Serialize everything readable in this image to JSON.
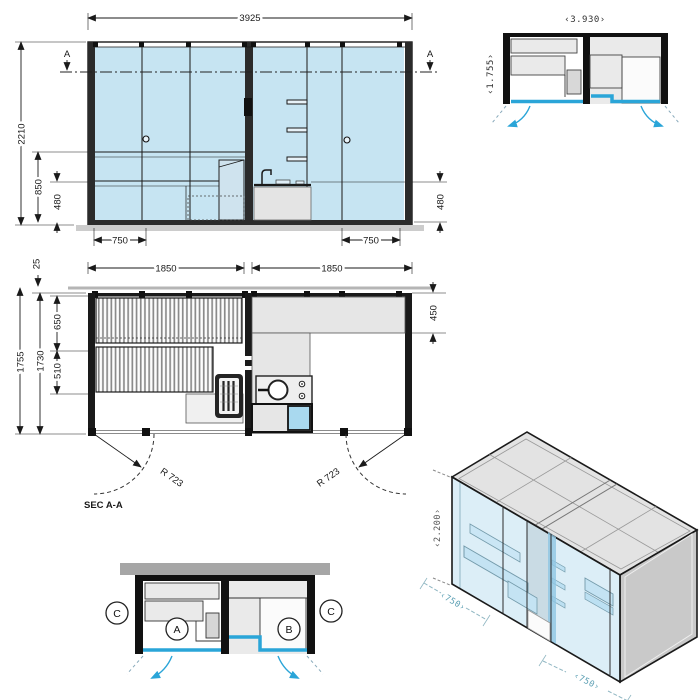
{
  "colors": {
    "glass": "#c6e4f2",
    "accent_blue": "#2aa5d8",
    "shower_blue": "#a9d9ef",
    "line": "#1a1a1a",
    "gray_light": "#e9e9e9",
    "gray_bar": "#a6a6a6",
    "ground": "#cccccc",
    "roof": "#e3e3e3",
    "end_wall": "#c9c9c9",
    "iso_dim_teal": "#5b9fb3"
  },
  "elevation": {
    "dim_width": "3925",
    "dim_height": "2210",
    "dim_bench_high": "850",
    "dim_bench_low": "480",
    "dim_door": "750",
    "section_marker": "A"
  },
  "plan": {
    "dim_module": "1850",
    "dim_gap": "25",
    "dim_depth_outer": "1755",
    "dim_depth_inner": "1730",
    "dim_bench_upper": "650",
    "dim_bench_lower": "510",
    "dim_counter": "450",
    "door_radius": "R 723",
    "section_label": "SEC A-A"
  },
  "plan_schematic": {
    "dim_width": "‹3.930›",
    "dim_depth": "‹1.755›"
  },
  "section_schematic": {
    "room_a": "A",
    "room_b": "B",
    "section_c": "C"
  },
  "isometric": {
    "dim_height": "‹2.200›",
    "dim_door": "‹750›"
  }
}
